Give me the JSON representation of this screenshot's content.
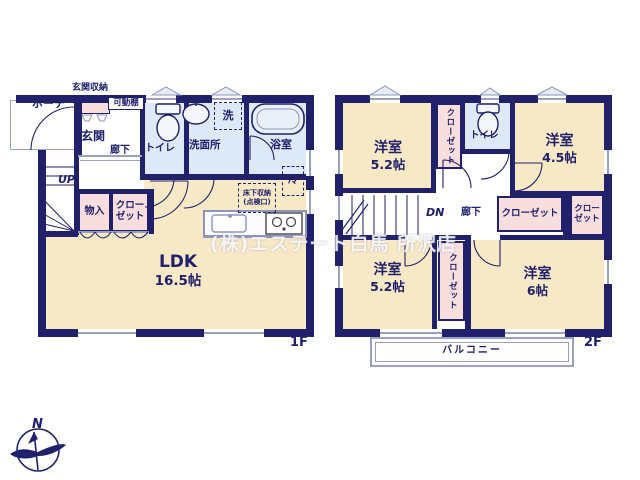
{
  "watermark": "(株)エステート白馬 所沢店",
  "compass": {
    "label": "N"
  },
  "colors": {
    "wall_navy": "#20206b",
    "floor_cream": "#f8e9c6",
    "wet_blue": "#dde9f6",
    "closet_pink": "#f9dede",
    "outline_gray": "#9aa0bf"
  },
  "floor1": {
    "label": "1F",
    "porch": "ポーチ",
    "entrance_storage": "玄関収納",
    "movable_shelf": "可動棚",
    "entrance": "玄関",
    "hallway": "廊下",
    "toilet": "トイレ",
    "laundry": "洗",
    "washroom": "洗面所",
    "bathroom": "浴室",
    "stairs": "UP",
    "storage": "物入",
    "closet": "クローゼット",
    "ldk": {
      "name": "LDK",
      "size": "16.5帖"
    },
    "underfloor_storage": "床下収納",
    "inspection_port": "(点検口)",
    "fridge": "冷"
  },
  "floor2": {
    "label": "2F",
    "room_nw": {
      "name": "洋室",
      "size": "5.2帖"
    },
    "closet_n": "クローゼット",
    "toilet": "トイレ",
    "room_ne": {
      "name": "洋室",
      "size": "4.5帖"
    },
    "stairs": "DN",
    "hallway": "廊下",
    "closet_mid_w": "クローゼット",
    "closet_mid_e": "クローゼット",
    "room_sw": {
      "name": "洋室",
      "size": "5.2帖"
    },
    "closet_s": "クローゼット",
    "room_se": {
      "name": "洋室",
      "size": "6帖"
    },
    "balcony": "バルコニー"
  }
}
